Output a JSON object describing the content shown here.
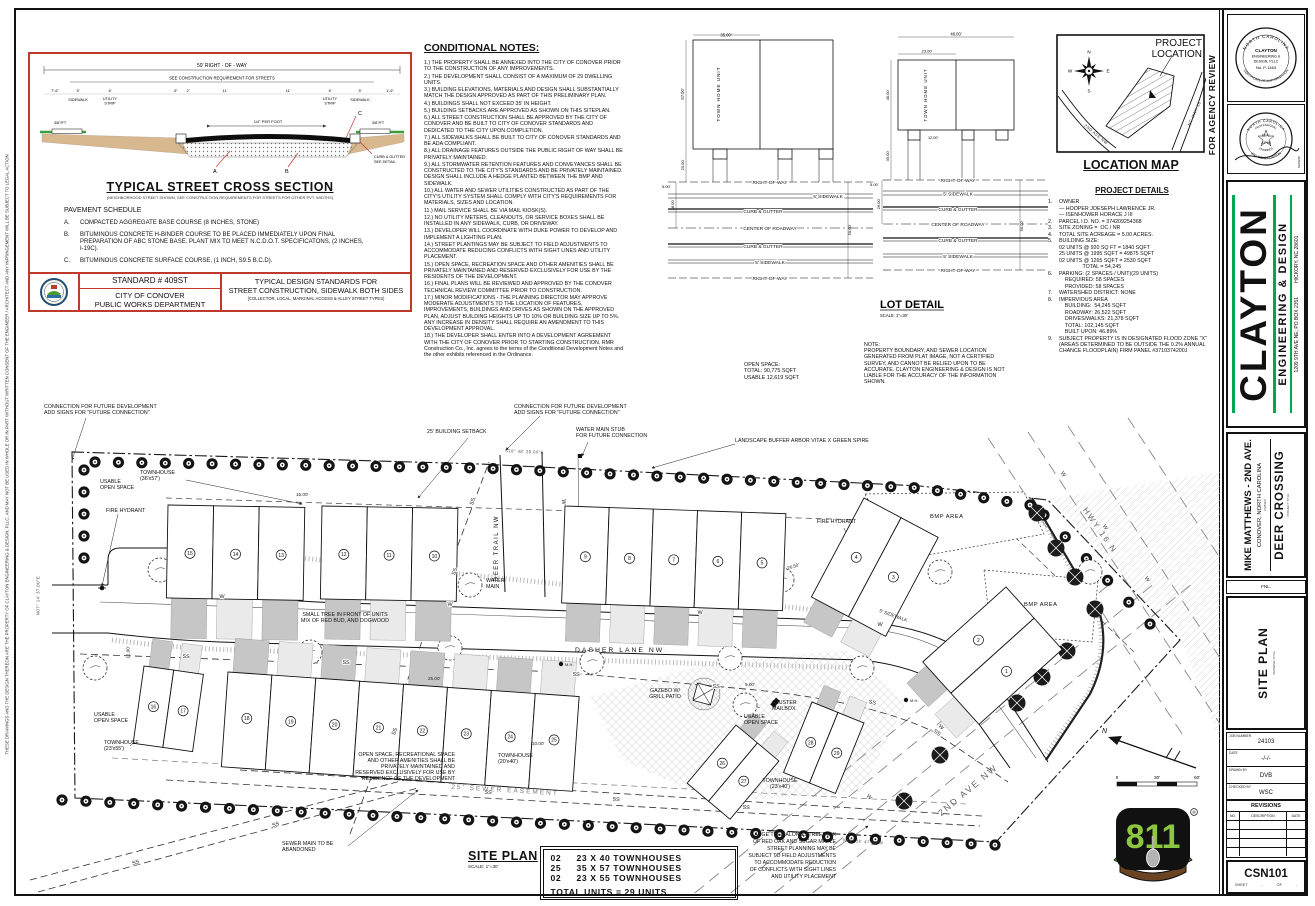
{
  "sheet": {
    "left_disclaimer": "THESE DRAWINGS AND THE DESIGN THEREON ARE THE PROPERTY OF CLAYTON ENGINEERING & DESIGN, PLLC, AND MAY NOT BE USED IN WHOLE OR IN PART WITHOUT WRITTEN CONSENT OF THE ENGINEER / ARCHITECT AND ANY INFRINGEMENT WILL BE SUBJECT TO LEGAL ACTION"
  },
  "cross_section": {
    "title": "TYPICAL STREET CROSS SECTION",
    "subtitle": "(NEIGHBORHOOD STREET SHOWN, SEE CONSTRUCTION REQUIREMENTS FOR STREETS FOR OTHER PVT. WIDTHS)",
    "dims": {
      "row": "50' RIGHT - OF - WAY",
      "construction": "SEE CONSTRUCTION REQUIREMENT FOR STREETS",
      "left_end": "7'-6\"",
      "right_end": "1'-6\"",
      "sidewalk_w": "5'",
      "utility_w": "6'",
      "curb": "6\"",
      "gutter": "2'",
      "lane_a": "11'",
      "lane_b": "11'",
      "crown": "1/4\" PER FOOT",
      "slope_left": "3/8\"/FT",
      "slope_right": "3/8\"/FT"
    },
    "labels": {
      "sidewalk": "SIDEWALK",
      "utility1": "UTILITY",
      "utility2": "STRIP",
      "curb_gutter1": "CURB & GUTTER",
      "curb_gutter2": "SEE DETAIL.",
      "a": "A",
      "b": "B",
      "c": "C"
    },
    "schedule": {
      "title": "PAVEMENT SCHEDULE",
      "items": [
        {
          "key": "A.",
          "text": "COMPACTED AGGREGATE BASE COURSE (8 INCHES, STONE)"
        },
        {
          "key": "B.",
          "text": "BITUMINOUS CONCRETE H-BINDER COURSE TO BE PLACED IMMEDIATELY UPON FINAL PREPARATION OF ABC STONE BASE.  PLANT MIX TO MEET N.C.D.O.T. SPECIFICATONS, (2 INCHES, I-19C)."
        },
        {
          "key": "C.",
          "text": "BITUMINOUS CONCRETE SURFACE COURSE, (1 INCH, S9.5 B.C.D)."
        }
      ]
    },
    "footer": {
      "standard": "STANDARD # 409ST",
      "dept1": "CITY OF CONOVER",
      "dept2": "PUBLIC WORKS DEPARTMENT",
      "right1": "TYPICAL DESIGN STANDARDS FOR",
      "right2": "STREET CONSTRUCTION, SIDEWALK BOTH SIDES",
      "right3": "(COLLECTOR, LOCAL, MARGINAL ACCESS & ALLEY STREET TYPES)"
    }
  },
  "conditional_notes": {
    "title": "CONDITIONAL NOTES:",
    "items": [
      "1.) THE PROPERTY SHALL BE ANNEXED INTO THE CITY OF CONOVER PRIOR TO THE CONSTRUCTION OF ANY IMPROVEMENTS.",
      "2.) THE DEVELOPMENT SHALL CONSIST OF A MAXIMUM OF 29 DWELLING UNITS.",
      "3.) BUILDING ELEVATIONS, MATERIALS AND DESIGN SHALL SUBSTANTIALLY MATCH THE DESIGN APPROVED AS PART OF THIS PRELIMINARY PLAN.",
      "4.) BUILDINGS SHALL NOT EXCEED 35' IN HEIGHT.",
      "5.) BUILDING SETBACKS ARE APPROVED AS SHOWN ON THIS SITEPLAN.",
      "6.) ALL STREET CONSTRUCTION SHALL BE APPROVED BY THE CITY OF CONOVER AND BE BUILT TO CITY OF CONOVER STANDARDS AND DEDICATED TO THE CITY UPON COMPLETION.",
      "7.) ALL SIDEWALKS SHALL BE BUILT TO CITY OF CONOVER STANDARDS AND BE ADA COMPLIANT.",
      "8.) ALL DRAINAGE FEATURES OUTSIDE THE PUBLIC RIGHT OF WAY SHALL BE PRIVATELY MAINTAINED.",
      "9.) ALL STORMWATER RETENTION FEATURES AND CONVEYANCES SHALL BE CONSTRUCTED TO THE CITY'S STANDARDS AND BE PRIVATELY MAINTAINED. DESIGN SHALL INCLUDE A HEDGE PLANTED BETWEEN THE BMP AND SIDEWALK.",
      "10.) ALL WATER AND SEWER UTILITIES CONSTRUCTED AS PART OF THE CITY'S UTILITY SYSTEM SHALL COMPLY WITH CITY'S REQUIREMENTS FOR MATERIALS, SIZES AND LOCATION.",
      "11.) MAIL SERVICE SHALL BE VIA MAIL KIOSK(S).",
      "12.) NO UTILITY METERS, CLEANOUTS, OR SERVICE BOXES SHALL BE INSTALLED IN ANY SIDEWALK, CURB, OR DRIVEWAY.",
      "13.) DEVELOPER WILL COORDINATE WITH DUKE POWER TO DEVELOP AND IMPLEMENT A LIGHTING PLAN.",
      "14.) STREET PLANTINGS MAY BE SUBJECT TO FIELD ADJUSTMENTS TO ACCOMMODATE REDUCING CONFLICTS WITH SIGHT LINES AND UTILITY PLACEMENT.",
      "15.) OPEN SPACE, RECREATION SPACE AND OTHER AMENITIES SHALL BE PRIVATELY MAINTAINED AND RESERVED EXCLUSIVELY FOR USE BY THE RESIDENTS OF THE DEVELOPMENT.",
      "16.) FINAL PLANS WILL BE REVIEWED AND APPROVED BY THE CONOVER TECHNICAL REVIEW COMMITTEE PRIOR TO CONSTRUCTION.",
      "17.) MINOR MODIFICATIONS - THE PLANNING DIRECTOR MAY APPROVE MODERATE ADJUSTMENTS TO THE LOCATION OF FEATURES, IMPROVEMENTS, BUILDINGS AND DRIVES AS SHOWN ON THE APPROVED PLAN, ADJUST BUILDING HEIGHTS UP TO 10% OR BUILDING SIZE UP TO 5%. ANY INCREASE IN DENSITY SHALL REQUIRE AN AMENDMENT TO THIS DEVELOPMENT APPROVAL.",
      "18.) THE DEVELOPER SHALL ENTER INTO A DEVELOPMENT AGREEMENT WITH THE CITY OF CONOVER PRIOR TO STARTING CONSTRUCTION. RMR Construction Co., Inc. agrees to the terms of the Conditional Development Notes and the other exhibits referenced in the Ordinance."
    ]
  },
  "lot_detail": {
    "title": "LOT DETAIL",
    "scale": "SCALE: 1\"=30'",
    "unit_label": "TOWN HOME UNIT",
    "road_labels": [
      "RIGHT-OF-WAY",
      "5' SIDEWALK",
      "CURB & GUTTER",
      "CENTER OF ROADWAY",
      "CURB & GUTTER",
      "5' SIDEWALK",
      "RIGHT-OF-WAY"
    ],
    "left": {
      "width": "35.00'",
      "height": "57.00'",
      "setback": "20.00'",
      "sidewalk": "5.00'",
      "road_half": "28.00'",
      "row_width": "50.00'"
    },
    "right": {
      "overall": "46.00'",
      "unit_width": "23.00'",
      "height": "40.00'",
      "setback": "35.00'",
      "stoop": "12.00'",
      "sidewalk": "5.00'",
      "road_half": "26.00'",
      "row_width": "50.00'"
    }
  },
  "location_map": {
    "title": "LOCATION MAP",
    "callout": "PROJECT\nLOCATION",
    "road1": "2ND AVE NW",
    "road2": "NC HWY 16",
    "compass": {
      "n": "N",
      "e": "E",
      "s": "S",
      "w": "W"
    },
    "agency_review": "FOR AGENCY REVIEW"
  },
  "project_details": {
    "title": "PROJECT DETAILS",
    "rows": [
      {
        "n": "1.",
        "t": "OWNER"
      },
      {
        "n": "",
        "t": "— HOOPER JOESEPH LAWRENCE JR."
      },
      {
        "n": "",
        "t": "— ISENHOWER HORACE J III"
      },
      {
        "n": "2.",
        "t": "PARCEL I.D. NO. = 374209254368"
      },
      {
        "n": "3.",
        "t": "SITE ZONING =  OC / NR"
      },
      {
        "n": "4.",
        "t": "TOTAL SITE ACREAGE = 5.00 ACRES."
      },
      {
        "n": "5.",
        "t": "BUILDING SIZE:"
      },
      {
        "n": "",
        "t": "02 UNITS @ 920 SQ FT = 1840 SQFT"
      },
      {
        "n": "",
        "t": "25 UNITS @ 1995 SQFT = 49875 SQFT"
      },
      {
        "n": "",
        "t": "02 UNITS @ 1265 SQFT = 2530 SQFT"
      },
      {
        "n": "",
        "t": "                TOTAL = 54,245"
      },
      {
        "n": "6.",
        "t": "PARKING: (2 SPACES / UNIT)(29 UNITS)"
      },
      {
        "n": "",
        "t": "    REQUIRED: 58 SPACES"
      },
      {
        "n": "",
        "t": "    PROVIDED: 58 SPACES"
      },
      {
        "n": "7.",
        "t": "WATERSHED DISTRICT: NONE"
      },
      {
        "n": "8.",
        "t": "IMPERVIOUS AREA"
      },
      {
        "n": "",
        "t": "    BUILDING:  54,245 SQFT"
      },
      {
        "n": "",
        "t": "    ROADWAY: 26,522 SQFT"
      },
      {
        "n": "",
        "t": "    DRIVES/WALKS: 21,378 SQFT"
      },
      {
        "n": "",
        "t": "    TOTAL: 102,145 SQFT"
      },
      {
        "n": "",
        "t": "    BUILT UPON: 46.89%"
      },
      {
        "n": "9.",
        "t": "SUBJECT PROPERTY IS IN DESIGNATED FLOOD ZONE \"X\" (AREAS DETERMINED TO BE OUTSIDE THE 0.2% ANNUAL CHANCE FLOODPLAIN) FIRM PANEL #3710374200J"
      }
    ]
  },
  "open_space_note": {
    "l1": "OPEN SPACE:",
    "l2": "TOTAL: 90,775 SQFT",
    "l3": "USABLE 12,619 SQFT"
  },
  "plat_note": "NOTE:\nPROPERTY BOUNDARY, AND SEWER LOCATION\nGENERATED FROM PLAT IMAGE, NOT A CERTIFIED\nSURVEY, AND CANNOT BE RELIED UPON TO BE\nACCURATE.  CLAYTON ENGINEERING & DESIGN IS NOT\nLIABLE FOR THE ACCURACY OF THE INFORMATION\nSHOWN.",
  "site_plan": {
    "title": "SITE PLAN",
    "scale": "SCALE: 1\"=30'",
    "labels": {
      "future_connection": "CONNECTION FOR FUTURE DEVELOPMENT\nADD SIGNS FOR \"FUTURE CONNECTION\"",
      "setback": "25' BUILDING SETBACK",
      "water_stub": "WATER MAIN STUB\nFOR FUTURE CONNECTION",
      "buffer": "LANDSCAPE BUFFER ARBOR VITAE X GREEN SPIRE",
      "townhouse_36": "TOWNHOUSE\n(36'x57')",
      "usable_open": "USABLE\nOPEN SPACE",
      "fire_hydrant": "FIRE HYDRANT",
      "small_tree": "SMALL TREE IN FRONT OF UNITS\nMIX OF RED BUD, AND DOGWOOD",
      "water_main": "WATER\nMAIN",
      "bmp": "BMP AREA",
      "sidewalk": "5' SIDEWALK",
      "gazebo": "GAZEBO W/\nGRILL PATIO",
      "cluster_mailbox": "CLUSTER\nMAILBOX",
      "townhouse_23x55": "TOWNHOUSE\n(23'x55')",
      "townhouse_20x40": "TOWNHOUSE\n(20'x40')",
      "townhouse_23x40": "TOWNHOUSE\n(23'x40')",
      "open_space_recreation": "OPEN SPACE, RECREATIONAL SPACE\nAND OTHER AMENITIES SHALL BE\nPRIVATELY MAINTAINED AND\nRESERVED EXCLUSIVELY FOR USE BY\nRESIDENCE OF THE DEVELOPMENT",
      "sewer_easement": "25' SEWER EASEMENT",
      "sewer_abandoned": "SEWER MAIN TO BE\nABANDONED",
      "large_tree": "LARGE TREE ALONG STREET MIX\nOF RED OAK AND SUGAR MAPLE\nSTREET PLANNING MAY BE\nSUBJECT TO FIELD ADJUSTMENTS\nTO ACCOMMODATE REDUCTION\nOF CONFLICTS WITH SIGHT LINES\nAND UTILITY PLACEMENT"
    },
    "roads": {
      "dasher": "DASHER LANE NW",
      "deer": "DEER TRAIL NW",
      "second_ave": "2ND AVE NW",
      "hwy": "HWY 16 N"
    },
    "dims": {
      "d15": "15.00'",
      "d2650": "26.50'",
      "d25": "25.00'",
      "d10": "10.00'",
      "d9": "9.00'",
      "d12": "12.00'"
    },
    "bearings": {
      "top": "S18° 48' 26.00\"E",
      "bottom": "N19° 16' 47.00\"W",
      "left": "N07° 14' 37.00\"E"
    },
    "utility": {
      "ss": "SS",
      "w": "W",
      "mh": "M.H."
    },
    "units": {
      "top_west": [
        "15",
        "14",
        "13",
        "12",
        "11",
        "10"
      ],
      "top_east": [
        "9",
        "8",
        "7",
        "6",
        "5"
      ],
      "ne_pair": [
        "4",
        "3"
      ],
      "east_pair": [
        "2",
        "1"
      ],
      "bottom_west": [
        "16",
        "17"
      ],
      "bottom_mid": [
        "18",
        "19",
        "20",
        "21",
        "22",
        "23",
        "24",
        "25"
      ],
      "diag_a": [
        "26",
        "27"
      ],
      "diag_b": [
        "28",
        "29"
      ]
    },
    "summary": {
      "rows": [
        {
          "qty": "02",
          "desc": "23 X 40 TOWNHOUSES"
        },
        {
          "qty": "25",
          "desc": "35 X 57 TOWNHOUSES"
        },
        {
          "qty": "02",
          "desc": "23 X 55 TOWNHOUSES"
        }
      ],
      "total": "TOTAL UNITS = 29 UNITS"
    },
    "north": "N",
    "scalebar": {
      "zero": "0",
      "mid": "30'",
      "end": "60'"
    }
  },
  "logo811": {
    "digits": "811",
    "reg": "®"
  },
  "title_block": {
    "seal1": {
      "ring_top": "NORTH CAROLINA",
      "center1": "CLAYTON",
      "center2": "ENGINEERING &",
      "center3": "DESIGN, PLLC",
      "center4": "No. P-1463",
      "ring_bottom": "CERTIFICATE OF AUTHORIZATION"
    },
    "seal2": {
      "ring_top": "NORTH CAROLINA",
      "arc1": "PROFESSIONAL",
      "center1": "SEAL",
      "center2": "42788",
      "arc2": "ENGINEER",
      "ring_bottom": "WILLIAM S. CLAYTON",
      "date": "01/06/25"
    },
    "firm": {
      "name": "CLAYTON",
      "tagline": "ENGINEERING & DESIGN",
      "address1": "1209 9TH AVE NE; PO BOX 2351",
      "address2": "HICKORY, NC 28601"
    },
    "project": {
      "client": "MIKE MATTHEWS - 2ND AVE.",
      "location": "CONOVER, NORTH CAROLINA",
      "owner_tag": "OWNER",
      "title": "DEER CROSSING",
      "title_tag": "PROJECT TITLE",
      "strip": "FNL."
    },
    "drawing": {
      "title": "SITE PLAN",
      "tag": "DRAWING TITLE"
    },
    "fields": {
      "job_label": "JOB NUMBER",
      "job": "24103",
      "date_label": "DATE",
      "date": "-/-/-",
      "drawn_label": "DRAWN BY",
      "drawn": "DVB",
      "checked_label": "CHECKED BY",
      "checked": "WSC"
    },
    "revisions": {
      "title": "REVISIONS",
      "no": "NO.",
      "desc": "DESCRIPTION",
      "date": "DATE"
    },
    "sheet": {
      "number": "CSN101",
      "sheet_label": "SHEET",
      "of_label": "OF"
    }
  },
  "colors": {
    "accent_red": "#c0392b",
    "logo_green": "#00a651",
    "digit_green": "#8dc63f",
    "grass_green": "#3a9d3a"
  }
}
